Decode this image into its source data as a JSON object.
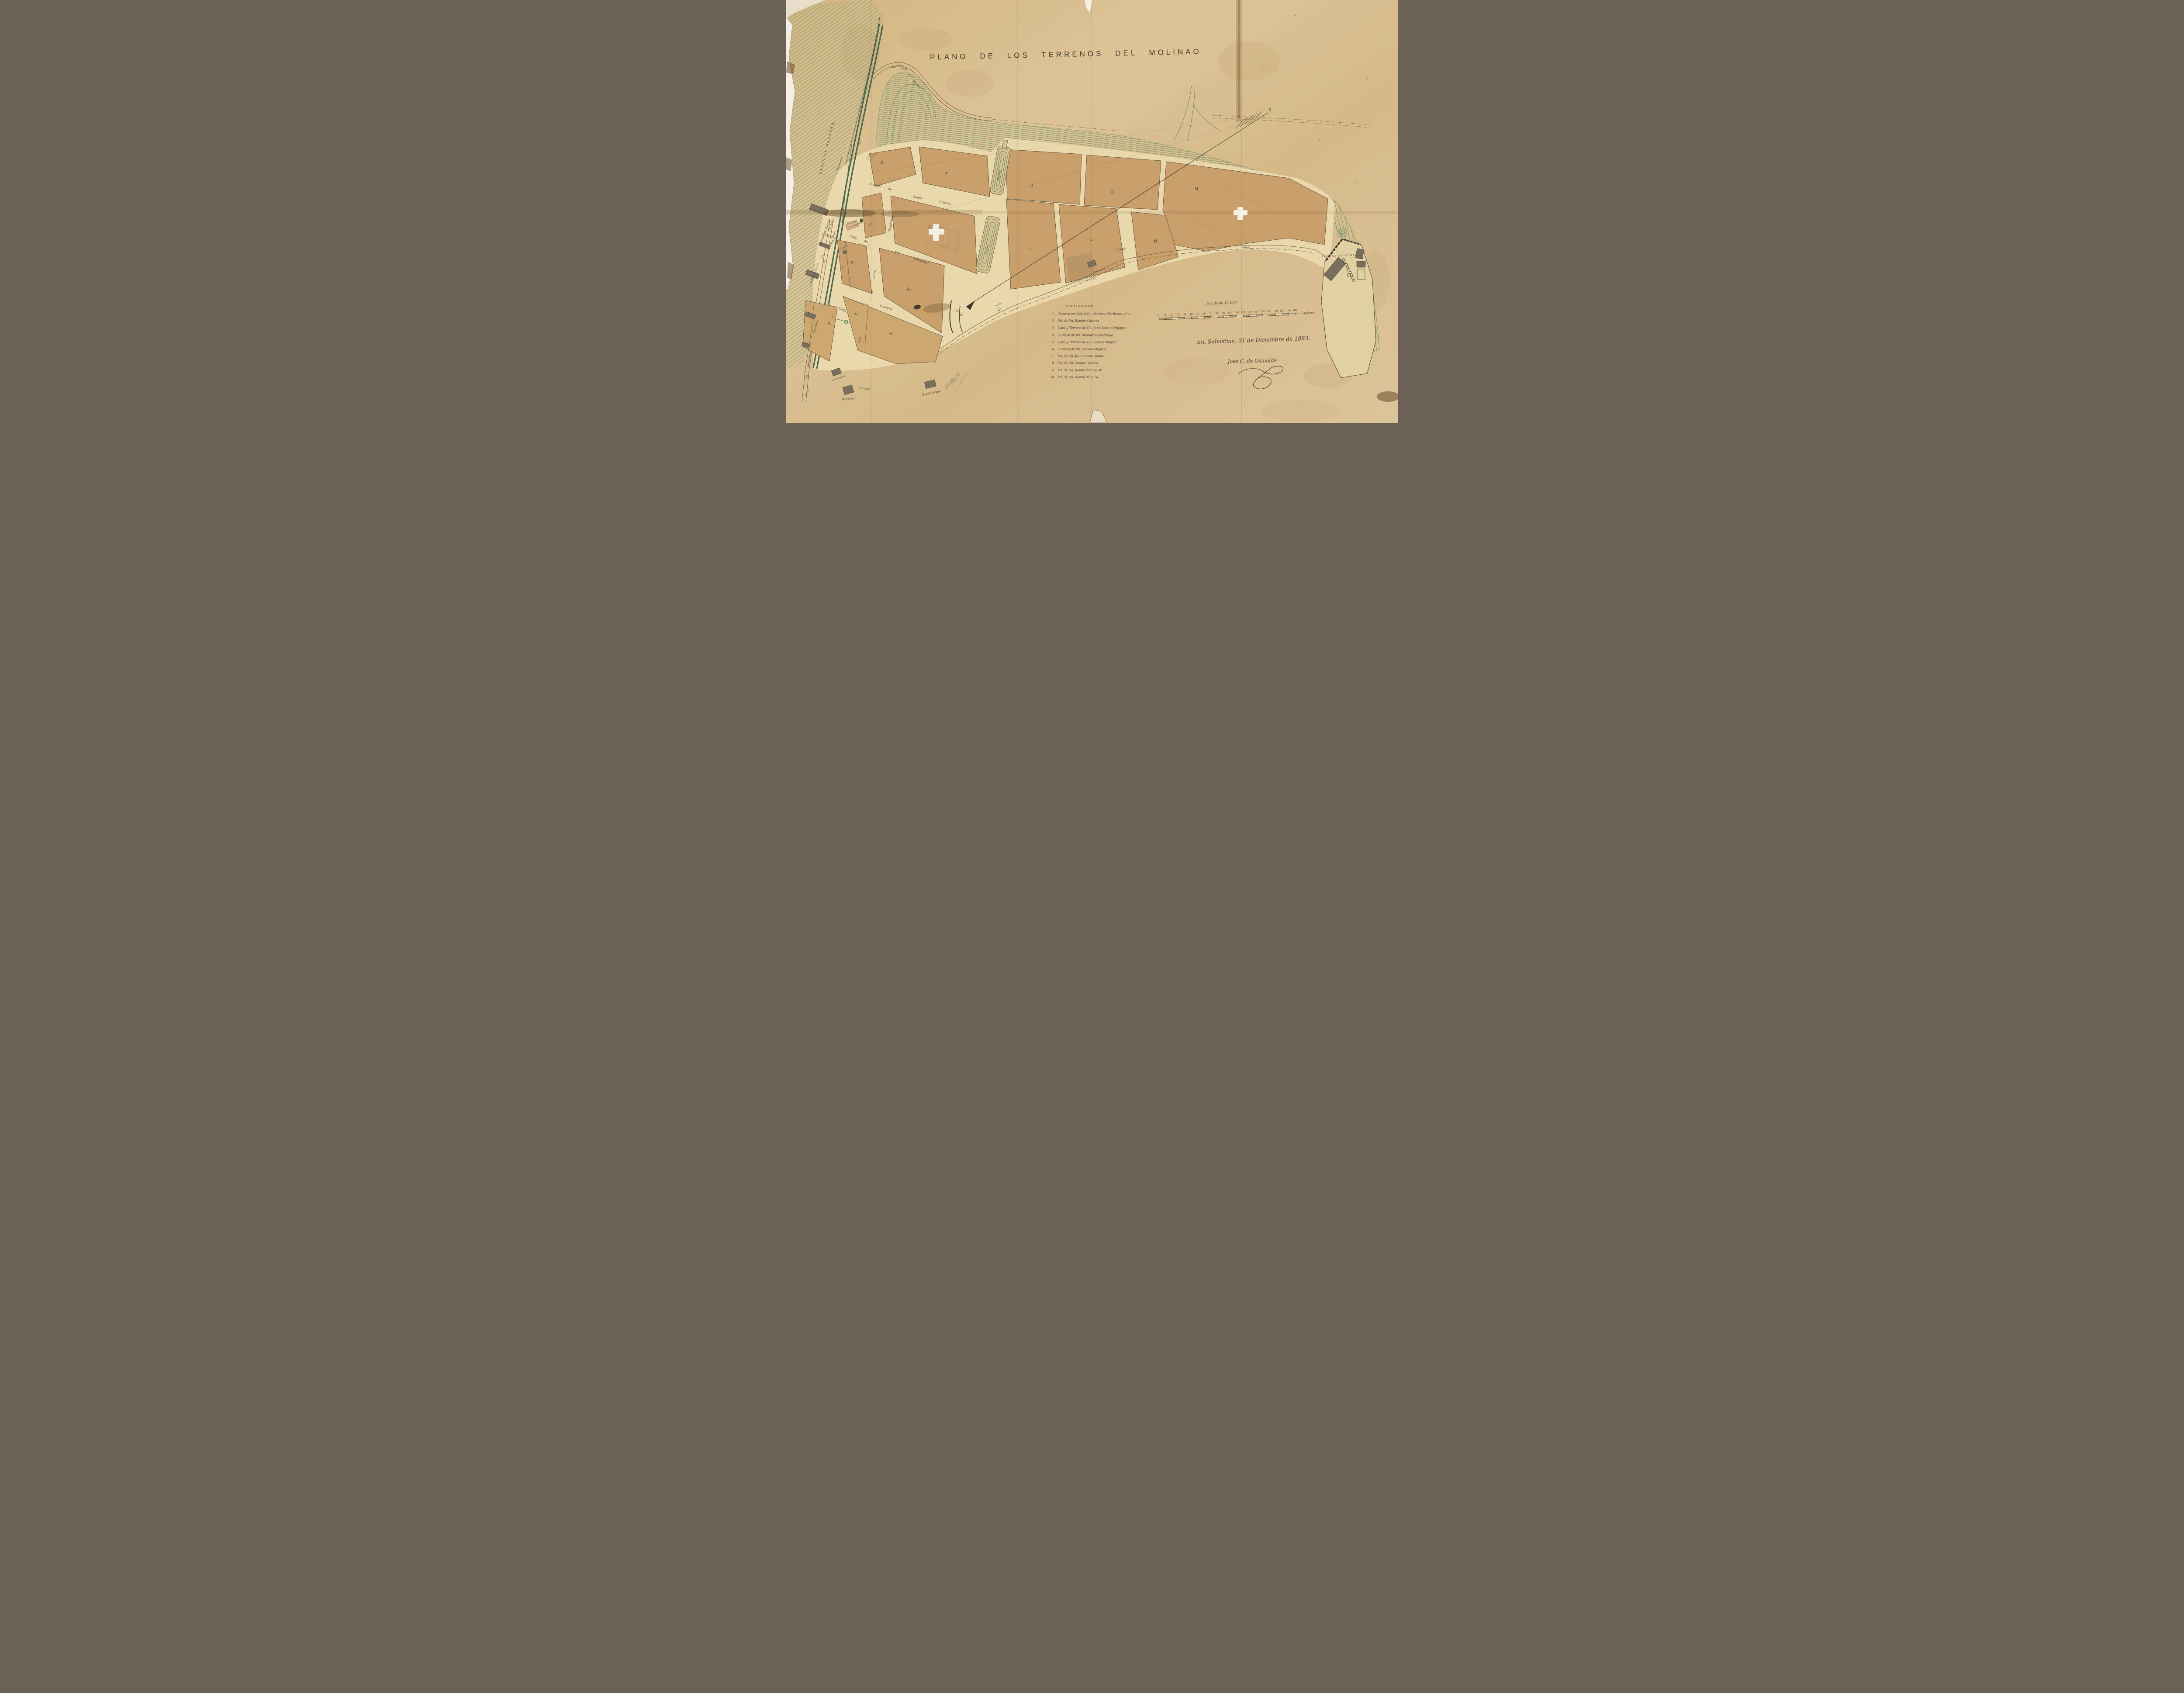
{
  "title": "PLANO DE LOS TERRENOS DEL MOLINAO",
  "bay_label": "BAHIA DE PASAGES",
  "roads": {
    "camino_san_marcos": [
      "Camino",
      "para",
      "San",
      "Marcos"
    ],
    "camino_mid": "Camino",
    "publico": "público",
    "camino_bottom_left": "Camino",
    "carretera": "Carretera"
  },
  "railway": {
    "company_1": "FERRO-CARRIL",
    "company_2": "DEL",
    "company_3": "NORTE",
    "station": "Estación de Pasages",
    "anden": "Anden",
    "almacenes": "Almacenes",
    "irun": "Irun",
    "a_prep": "á",
    "estacion_proyecto_1": "Estación",
    "estacion_proyecto_2": "en proyecto",
    "cantina": "Cantina"
  },
  "streets": {
    "avenida": [
      "Avenida",
      "de",
      "Santa",
      "Cristina"
    ],
    "san_sebastian": [
      "Calle",
      "de",
      "San",
      "Sebastian"
    ],
    "pasages": [
      "Calle",
      "de",
      "Pasages"
    ],
    "magdalena": "Magdalena",
    "santa_cross": [
      "Santa.",
      "de"
    ],
    "calle_vert": "Calle",
    "west_street": [
      "de",
      "San",
      "Sebastian"
    ]
  },
  "blocks": {
    "A": "A",
    "B": "B",
    "C": "C",
    "D": "D",
    "E": "E",
    "F": "F",
    "G": "G",
    "H": "H",
    "I": "I",
    "J": "J",
    "K": "K",
    "L": "L",
    "M": "M",
    "N": "N"
  },
  "parcels": {
    "n1": "1",
    "n2": "2",
    "n3": "3",
    "n4": "4",
    "n5": "5",
    "n6": "6",
    "n8": "8",
    "n10": "10"
  },
  "features": {
    "muelles": "Muelles",
    "fabrica": "FABRICA DE PETROLEO",
    "fuente_bridge": "Fuente",
    "fuente_field": "Fuente",
    "antepuerta": "antepuerta",
    "berra_bia": "Berra-bia",
    "escalantegui": "Escalantégui",
    "averrenta": "Averrenta"
  },
  "compass": {
    "s": "S",
    "n": "N",
    "m": "M"
  },
  "legend": {
    "title": "ESPLICACION",
    "items": [
      {
        "num": "1",
        "text": "Terreno vendido á Dn. Mariano Borderas y Cia."
      },
      {
        "num": "2",
        "text": "Yd.  de Dn. Ramon Casares"
      },
      {
        "num": "3",
        "text": "Casa y Terreno de Dn. Juan Sanz é Yrigoyen"
      },
      {
        "num": "4",
        "text": "Terreno de Dn. Manuel Usandizaga"
      },
      {
        "num": "5",
        "text": "Casa y Terreno de Dn. Santos Mùgica"
      },
      {
        "num": "6",
        "text": "Terreno de Dn. Ramon Mùgica"
      },
      {
        "num": "7",
        "text": "Yd.  de Dn. Jose Alonso Gomez"
      },
      {
        "num": "8",
        "text": "Yd.  de Dn. Manuel Urcola"
      },
      {
        "num": "9",
        "text": "Yd.  de Dn. Benito Olasagasti"
      },
      {
        "num": "10",
        "text": "Yd.  de Dn. Santos Mùgica"
      }
    ]
  },
  "scale_bar": {
    "title": "Escala de 1/1000",
    "ticks": [
      "10",
      "0",
      "10",
      "20",
      "30",
      "40",
      "50",
      "60",
      "70",
      "80",
      "90",
      "100",
      "110",
      "120",
      "130",
      "140",
      "150",
      "160",
      "170",
      "180",
      "190",
      "200"
    ],
    "unit": "Metros"
  },
  "signature": {
    "line1": "Sn. Sebastian, 31 de Diciembre de 1883.",
    "line2": "José C. de Osinalde"
  },
  "pencil_notes": {
    "a": "1352,21",
    "b": "935,24",
    "c": "10 casas"
  },
  "colors": {
    "paper": "#d8bd8e",
    "street_cream": "#ead7ab",
    "block_tan": "#c89f6a",
    "contour_green": "#5f8f6b",
    "railway_green": "#447a55",
    "ink": "#4a4134",
    "building_gray": "#76705d",
    "proyecto_pink": "#c98a74"
  }
}
